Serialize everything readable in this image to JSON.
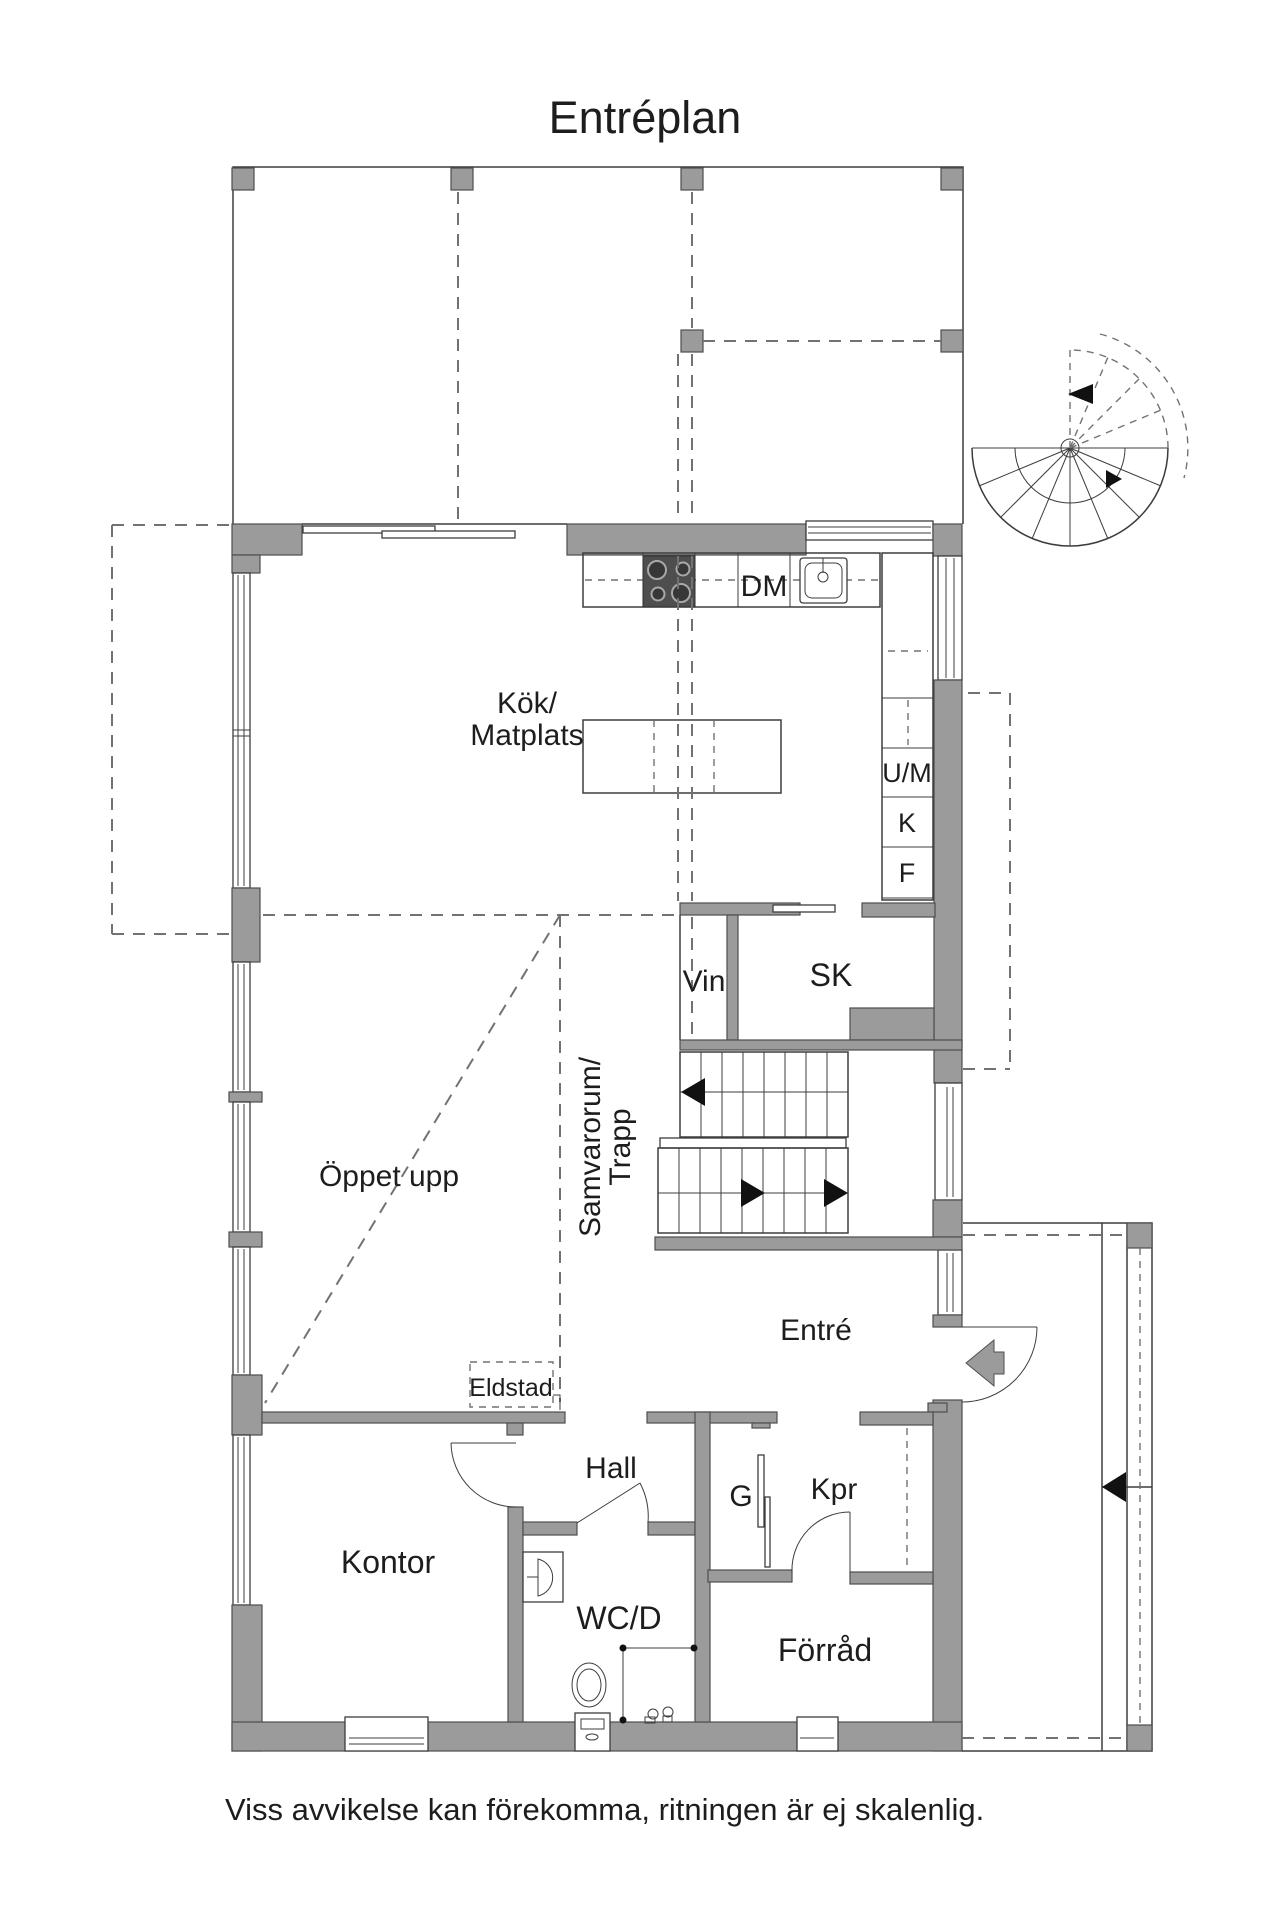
{
  "title": "Entréplan",
  "footer": "Viss avvikelse kan förekomma, ritningen är ej skalenlig.",
  "labels": {
    "kok_line1": "Kök/",
    "kok_line2": "Matplats",
    "dm": "DM",
    "um": "U/M",
    "k": "K",
    "f": "F",
    "vin": "Vin",
    "sk": "SK",
    "oppet_upp": "Öppet upp",
    "samvarorum_line1": "Samvarorum/",
    "samvarorum_line2": "Trapp",
    "eldstad": "Eldstad",
    "entre": "Entré",
    "hall": "Hall",
    "kontor": "Kontor",
    "garderob": "G",
    "kpr": "Kpr",
    "wcd": "WC/D",
    "forrad": "Förråd"
  },
  "colors": {
    "background": "#ffffff",
    "wall": "#9b9b9b",
    "wall_outline": "#4e4e4e",
    "line": "#3d3d3d",
    "dash": "#727272",
    "text": "#1d1d1d",
    "arrow_dark": "#111111"
  }
}
